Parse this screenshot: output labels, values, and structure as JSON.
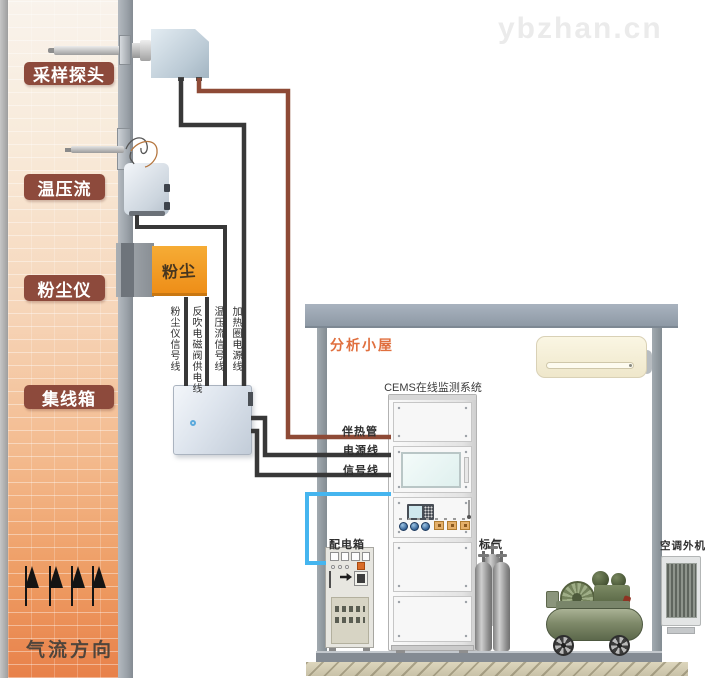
{
  "watermark": {
    "text": "ybzhan.cn"
  },
  "stack": {
    "labels": [
      {
        "text": "采样探头"
      },
      {
        "text": "温压流"
      },
      {
        "text": "粉尘仪"
      },
      {
        "text": "集线箱"
      }
    ],
    "dust_device_text": "粉尘",
    "flow_direction_text": "气流方向"
  },
  "wires": {
    "vertical_labels": [
      "粉尘仪信号线",
      "反吹电磁阀供电线",
      "温压流信号线",
      "加热圈电源线"
    ],
    "heat_trace_label": "伴热管",
    "power_label": "电源线",
    "signal_label": "信号线",
    "colors": {
      "heat_trace": "#8e4a36",
      "power_signal": "#383838",
      "control_cable": "#45b5ef"
    }
  },
  "shed": {
    "title": "分析小屋",
    "cems_system_label": "CEMS在线监测系统",
    "power_distribution_label": "配电箱",
    "standard_gas_label": "标气",
    "outdoor_ac_label": "空调外机"
  },
  "colors": {
    "stack_label_plate": "#8d4a3c",
    "shed_frame": "#97a3af",
    "flue_gradient_top": "#f9f3ec",
    "flue_gradient_bottom": "#e8814a",
    "dust_meter_body": "#f2a028"
  }
}
